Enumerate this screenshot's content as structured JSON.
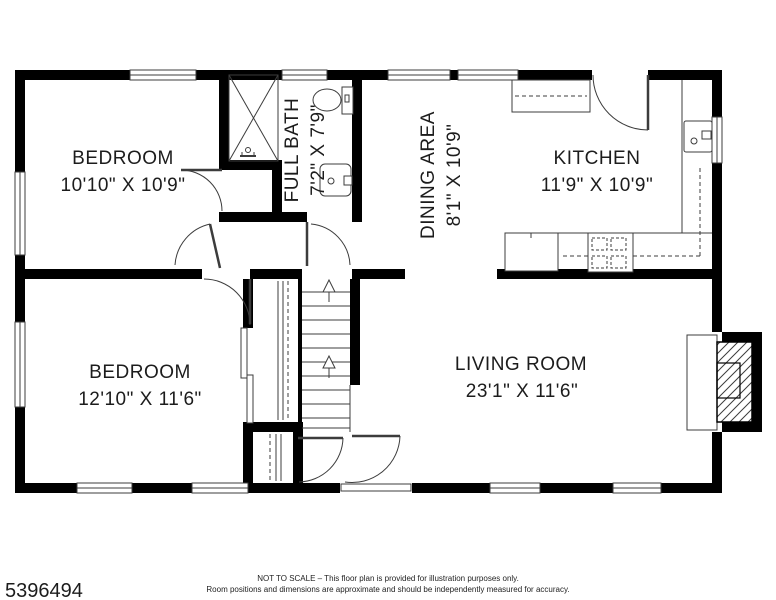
{
  "footer": {
    "listing_id": "5396494",
    "disclaimer_line1": "NOT TO SCALE – This floor plan is provided for illustration purposes only.",
    "disclaimer_line2": "Room positions and dimensions are approximate and should be independently measured for accuracy."
  },
  "rooms": {
    "bedroom1": {
      "name": "BEDROOM",
      "dims": "10'10\" X 10'9\""
    },
    "full_bath": {
      "name": "FULL BATH",
      "dims": "7'2\" X 7'9\""
    },
    "dining": {
      "name": "DINING AREA",
      "dims": "8'1\" X 10'9\""
    },
    "kitchen": {
      "name": "KITCHEN",
      "dims": "11'9\" X 10'9\""
    },
    "bedroom2": {
      "name": "BEDROOM",
      "dims": "12'10\" X 11'6\""
    },
    "living": {
      "name": "LIVING ROOM",
      "dims": "23'1\" X 11'6\""
    }
  },
  "colors": {
    "wall": "#000000",
    "line": "#3c3c3c",
    "text": "#1c1c1c",
    "background": "#ffffff"
  }
}
